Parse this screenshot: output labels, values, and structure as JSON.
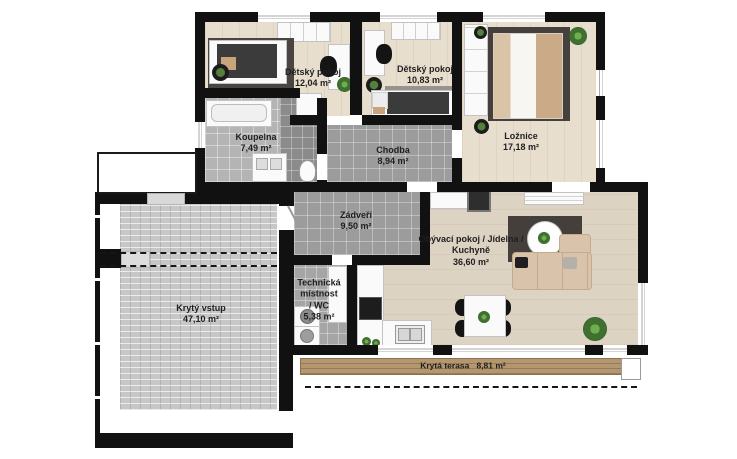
{
  "plan": {
    "type": "floor-plan",
    "language": "cs",
    "rooms": [
      {
        "id": "detsky-pokoj-1",
        "name": "Dětský pokoj",
        "area": "12,04 m²"
      },
      {
        "id": "detsky-pokoj-2",
        "name": "Dětský pokoj",
        "area": "10,83 m²"
      },
      {
        "id": "loznice",
        "name": "Ložnice",
        "area": "17,18 m²"
      },
      {
        "id": "koupelna",
        "name": "Koupelna",
        "area": "7,49 m²"
      },
      {
        "id": "chodba",
        "name": "Chodba",
        "area": "8,94 m²"
      },
      {
        "id": "zadveri",
        "name": "Zádveří",
        "area": "9,50 m²"
      },
      {
        "id": "technicka-mistnost-wc",
        "name": "Technická\nmístnost\n/ WC",
        "area": "5,38 m²"
      },
      {
        "id": "obyvaci-pokoj-jidelna-kuchyne",
        "name": "Obývací pokoj / Jídelna /\nKuchyně",
        "area": "36,60 m²"
      },
      {
        "id": "kryty-vstup",
        "name": "Krytý vstup",
        "area": "47,10 m²"
      },
      {
        "id": "kryta-terasa",
        "name": "Krytá terasa",
        "area": "8,81 m²"
      }
    ],
    "colors": {
      "wall": "#111111",
      "wood_bedroom": "#e8decd",
      "wood_living": "#ddd3c3",
      "tile_gray": "#9c9c9c",
      "tile_bath": "#b4b4b4",
      "pavers": "#c7c7c7",
      "deck_wood": "#b5976f",
      "rug_dark": "#45403c",
      "sofa_beige": "#d9c4ab",
      "plant_green": "#4e8a3f",
      "label_text": "#1f1f1f"
    }
  }
}
